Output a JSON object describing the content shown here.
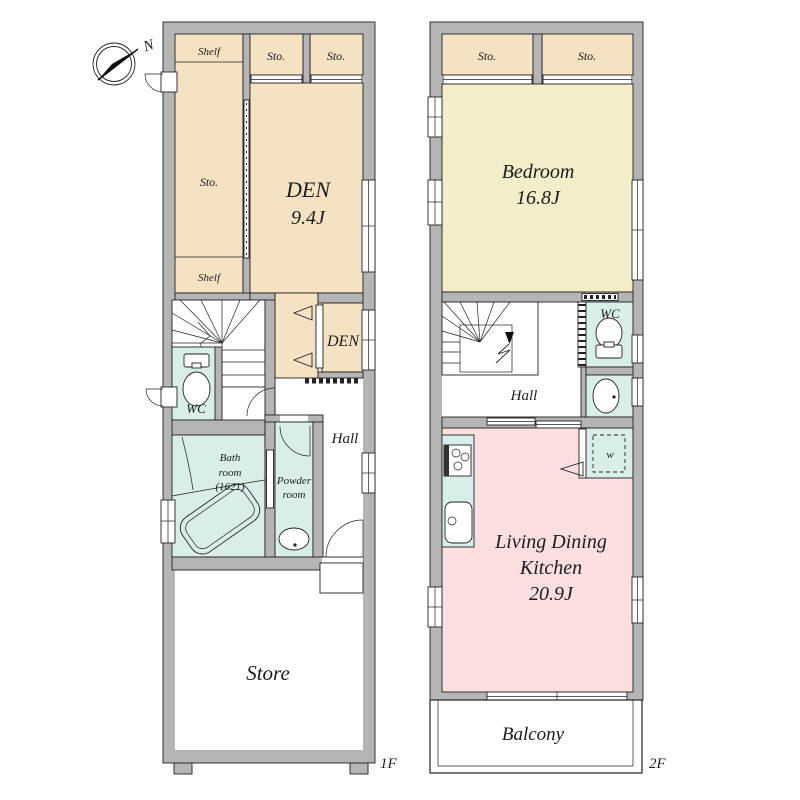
{
  "compass": {
    "north": "N"
  },
  "floor1": {
    "label": "1F",
    "shelf_top": "Shelf",
    "sto": "Sto.",
    "shelf_bottom": "Shelf",
    "closet_left": "Sto.",
    "closet_right": "Sto.",
    "den_name": "DEN",
    "den_size": "9.4J",
    "den_small": "DEN",
    "wc": "WC",
    "hall": "Hall",
    "bath_line1": "Bath",
    "bath_line2": "room",
    "bath_line3": "(1621)",
    "powder_line1": "Powder",
    "powder_line2": "room",
    "store": "Store"
  },
  "floor2": {
    "label": "2F",
    "closet_left": "Sto.",
    "closet_right": "Sto.",
    "bedroom_name": "Bedroom",
    "bedroom_size": "16.8J",
    "wc": "WC",
    "hall": "Hall",
    "ldk_line1": "Living Dining",
    "ldk_line2": "Kitchen",
    "ldk_size": "20.9J",
    "washer": "w",
    "balcony": "Balcony"
  },
  "colors": {
    "wall_gray": "#b5b5b5",
    "storage_beige": "#f5e2c2",
    "bedroom_yellow": "#f4edca",
    "ldk_pink": "#fbdfde",
    "wet_room_teal": "#d9eee8",
    "outline": "#222222"
  }
}
